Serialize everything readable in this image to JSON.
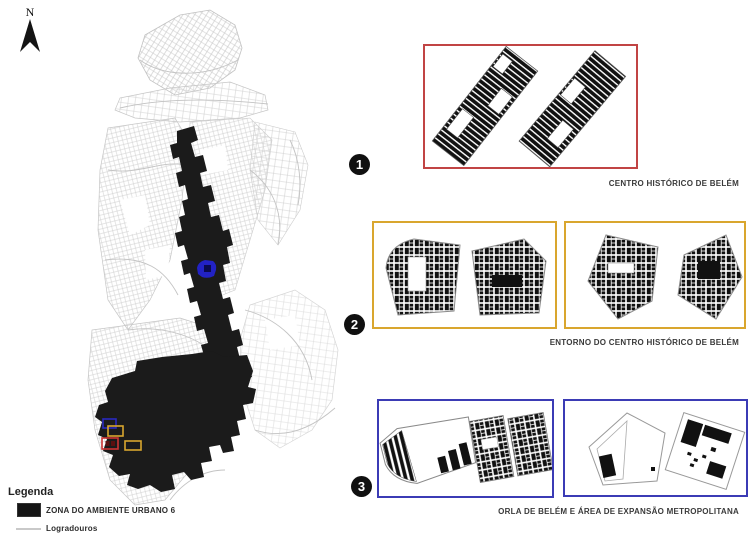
{
  "north_indicator": {
    "label": "N"
  },
  "map": {
    "zone_fill": "#1b1b1b",
    "street_line": "#c9c9c9",
    "highlight_blob_color": "#2222C4",
    "locator_marker_colors": [
      "#2A2AC0",
      "#D9A62E",
      "#CC3333",
      "#D9A62E"
    ]
  },
  "legend": {
    "title": "Legenda",
    "items": [
      {
        "label": "ZONA DO AMBIENTE URBANO 6",
        "swatch": "black-rect"
      },
      {
        "label": "Logradouros",
        "swatch": "gray-line"
      }
    ]
  },
  "panels": [
    {
      "number": "1",
      "label": "CENTRO HISTÓRICO DE BELÉM",
      "border_color": "#C14444"
    },
    {
      "number": "2",
      "label": "ENTORNO DO CENTRO HISTÓRICO DE BELÉM",
      "border_color": "#D9A62E"
    },
    {
      "number": "3",
      "label": "ORLA DE BELÉM E ÁREA DE EXPANSÃO METROPOLITANA",
      "border_color": "#3B3BB5"
    }
  ]
}
